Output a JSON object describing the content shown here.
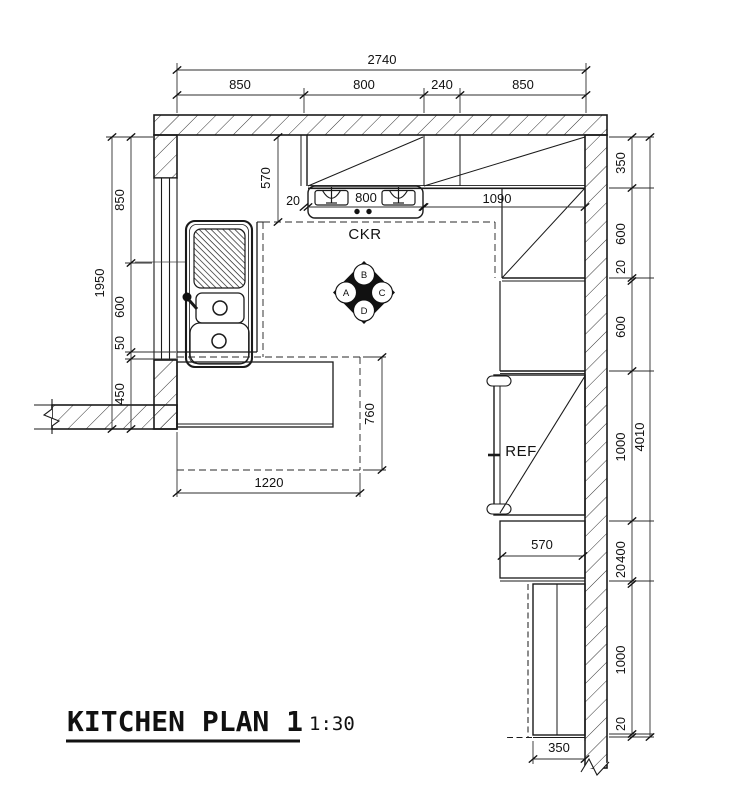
{
  "title": {
    "text": "KITCHEN PLAN 1",
    "scale": "1:30"
  },
  "plan": {
    "cooker_label": "CKR",
    "fridge_label": "REF",
    "section_marker": {
      "top": "B",
      "left": "A",
      "right": "C",
      "bottom": "D"
    }
  },
  "dims": {
    "top_total": "2740",
    "top": [
      "850",
      "800",
      "240",
      "850"
    ],
    "left_total": "1950",
    "left": [
      "850",
      "600",
      "50",
      "450"
    ],
    "right_total": "4010",
    "right": [
      "350",
      "600",
      "20",
      "600",
      "1000",
      "400",
      "20",
      "1000",
      "20"
    ],
    "worktop_depth": "570",
    "hob_gap": "20",
    "hob_width": "800",
    "upper_cabinet_run": "1090",
    "peninsula_length": "1220",
    "peninsula_depth": "760",
    "right_counter_width": "570",
    "tall_unit_width": "350"
  },
  "colors": {
    "line": "#1a1a1a",
    "dim_line": "#2e2e2e",
    "background": "#ffffff"
  }
}
